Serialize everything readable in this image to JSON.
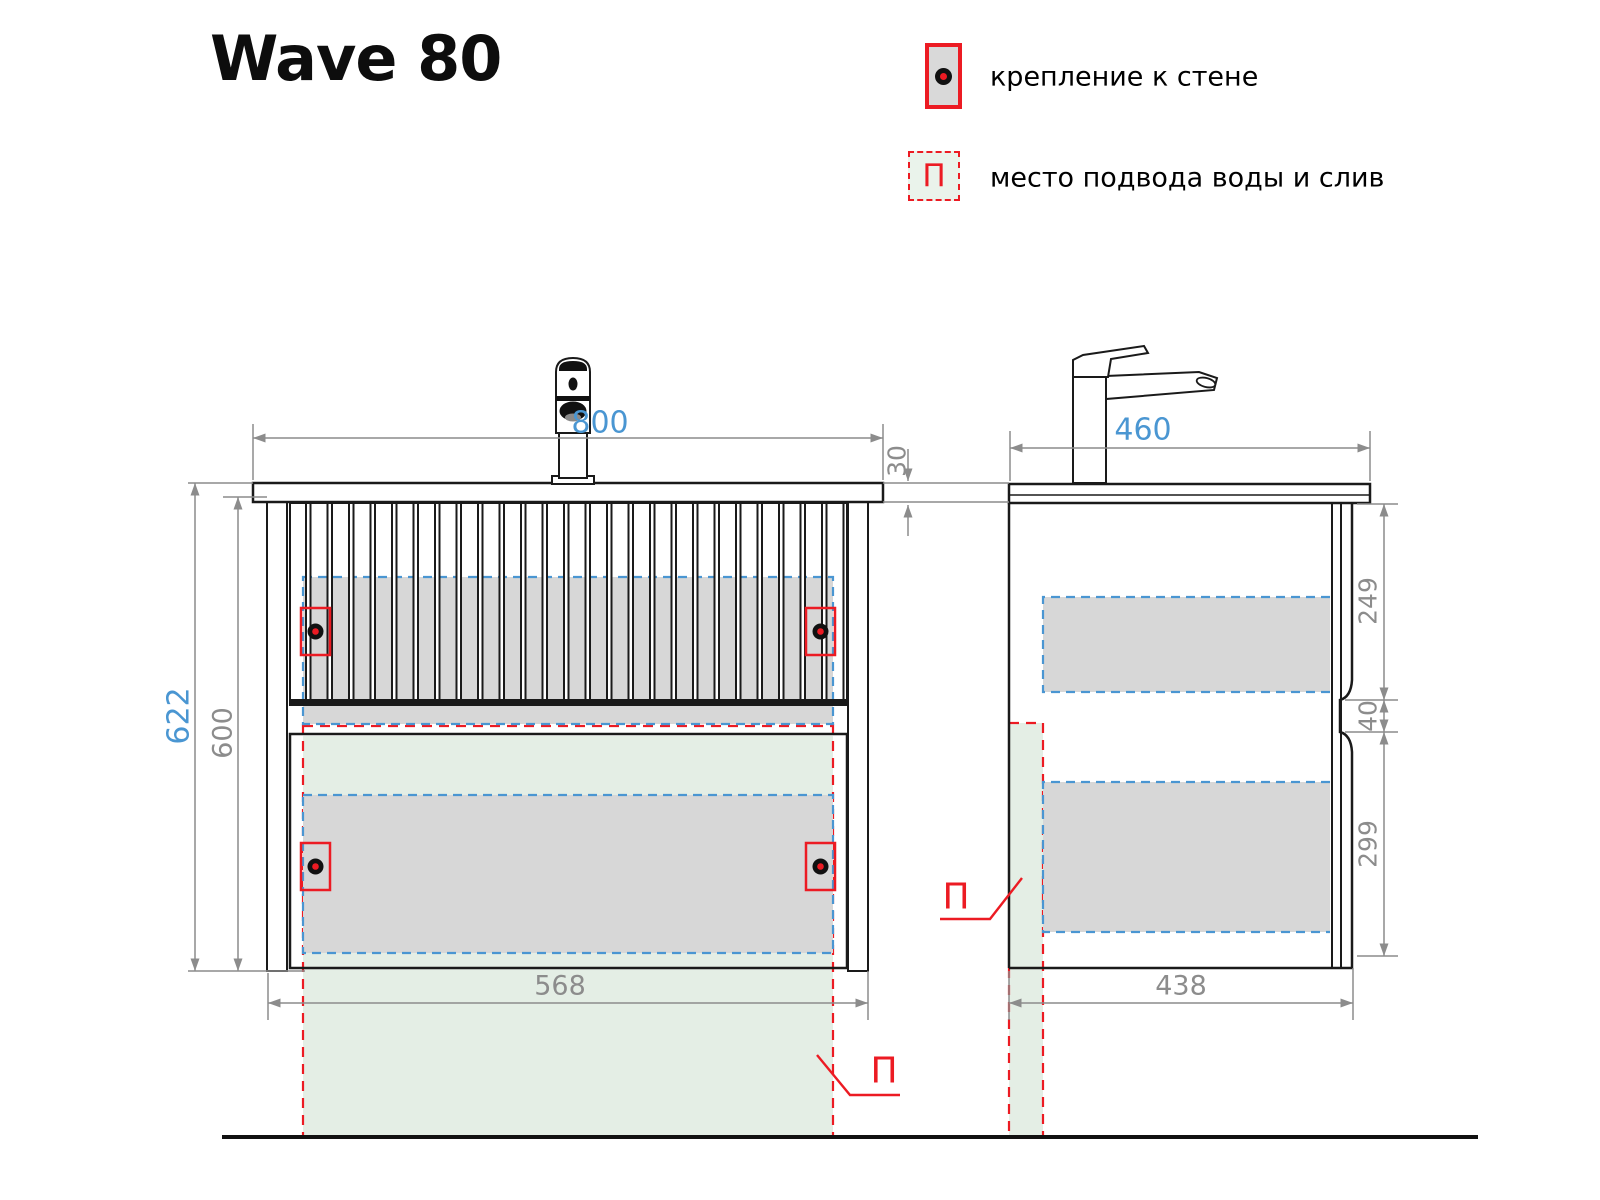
{
  "title": "Wave 80",
  "legend": {
    "items": [
      {
        "symbol": "wall-mount-marker",
        "label": "крепление к стене"
      },
      {
        "symbol": "water-supply-zone",
        "letter": "П",
        "label": "место подвода воды и слив"
      }
    ]
  },
  "front_view": {
    "dims": {
      "width": "800",
      "top_thickness": "30",
      "height_total": "622",
      "height_body": "600",
      "width_bottom": "568"
    },
    "marker_letter": "П"
  },
  "side_view": {
    "dims": {
      "depth": "460",
      "upper_zone": "249",
      "gap": "40",
      "lower_zone": "299",
      "depth_bottom": "438"
    },
    "marker_letter": "П"
  },
  "colors": {
    "dim_blue": "#4a96d2",
    "dim_gray": "#8c8c8c",
    "accent_red": "#ec1b23",
    "line_black": "#1a1a1a",
    "zone_gray": "#d7d7d7",
    "zone_green": "#e4eee5"
  }
}
